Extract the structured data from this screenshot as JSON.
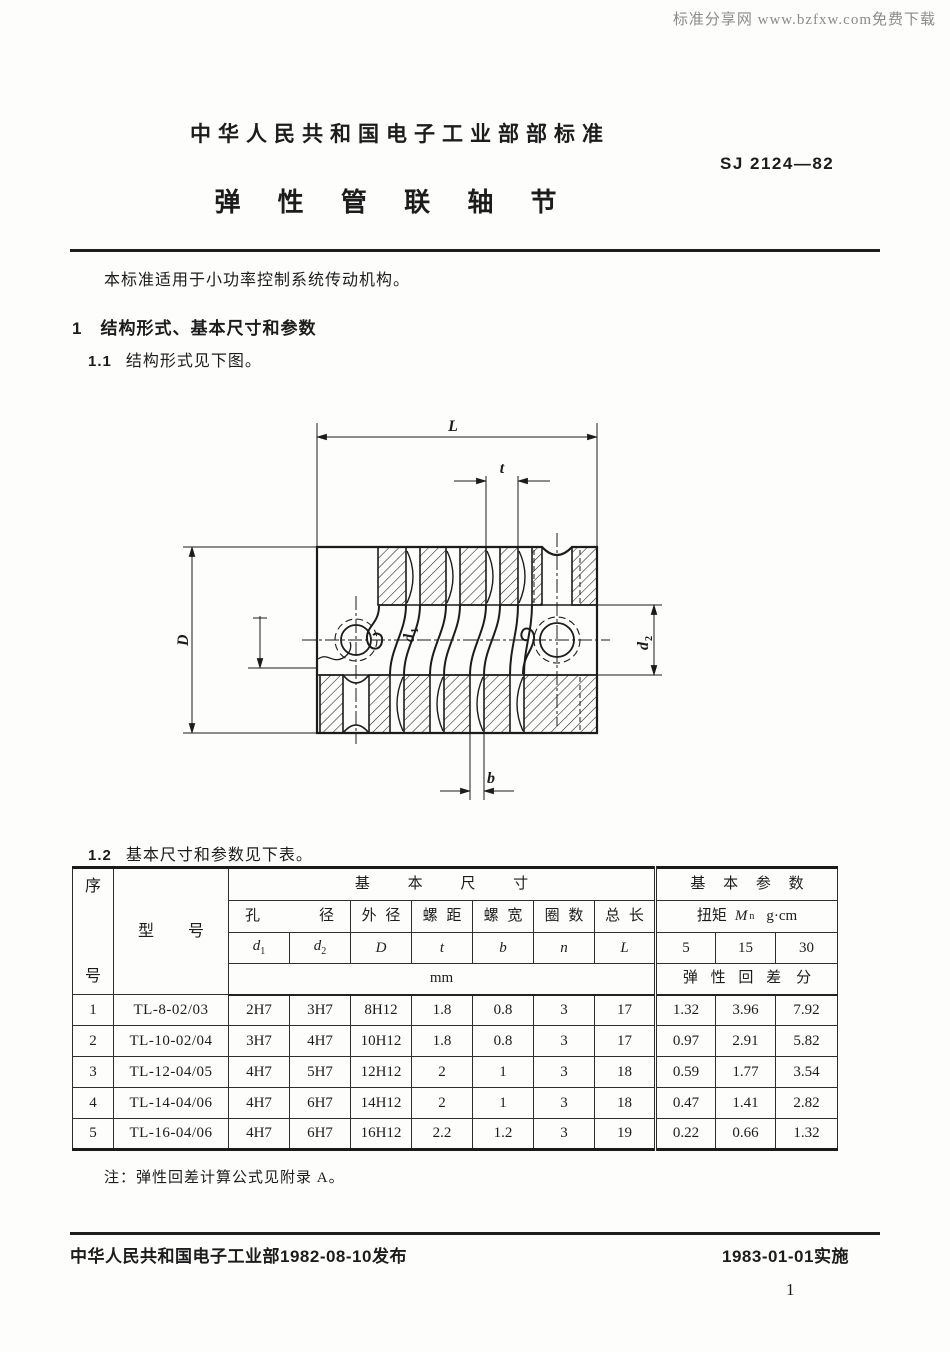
{
  "watermark": "标准分享网 www.bzfxw.com免费下载",
  "header": {
    "ministry_line": "中华人民共和国电子工业部部标准",
    "standard_no": "SJ 2124—82",
    "title": "弹 性 管 联 轴 节"
  },
  "intro": "本标准适用于小功率控制系统传动机构。",
  "section1": {
    "heading": "1　结构形式、基本尺寸和参数",
    "s11_num": "1.1",
    "s11_text": "结构形式见下图。",
    "s12_num": "1.2",
    "s12_text": "基本尺寸和参数见下表。"
  },
  "figure": {
    "labels": {
      "L": "L",
      "t": "t",
      "D": "D",
      "d": "d",
      "sub1": "1",
      "sub2": "2",
      "b": "b"
    }
  },
  "table": {
    "col_xu": "序",
    "col_hao": "号",
    "col_model": "型 号",
    "group_dims": "基 本 尺 寸",
    "group_params": "基 本 参 数",
    "sub_bore_left": "孔",
    "sub_bore_right": "径",
    "sub_od": "外 径",
    "sub_pitch": "螺 距",
    "sub_width": "螺 宽",
    "sub_turns": "圈 数",
    "sub_len": "总 长",
    "torque_prefix": "扭矩",
    "torque_symbol": "M",
    "torque_sub": "n",
    "torque_unit": "g·cm",
    "sym": {
      "d": "d",
      "s1": "1",
      "s2": "2",
      "D": "D",
      "t": "t",
      "b": "b",
      "n": "n",
      "L": "L"
    },
    "torque_values": [
      "5",
      "15",
      "30"
    ],
    "unit_mm": "mm",
    "backlash_label": "弹 性 回 差　分",
    "rows": [
      {
        "no": "1",
        "model": "TL-8-02/03",
        "d1": "2H7",
        "d2": "3H7",
        "D": "8H12",
        "t": "1.8",
        "b": "0.8",
        "n": "3",
        "L": "17",
        "v5": "1.32",
        "v15": "3.96",
        "v30": "7.92"
      },
      {
        "no": "2",
        "model": "TL-10-02/04",
        "d1": "3H7",
        "d2": "4H7",
        "D": "10H12",
        "t": "1.8",
        "b": "0.8",
        "n": "3",
        "L": "17",
        "v5": "0.97",
        "v15": "2.91",
        "v30": "5.82"
      },
      {
        "no": "3",
        "model": "TL-12-04/05",
        "d1": "4H7",
        "d2": "5H7",
        "D": "12H12",
        "t": "2",
        "b": "1",
        "n": "3",
        "L": "18",
        "v5": "0.59",
        "v15": "1.77",
        "v30": "3.54"
      },
      {
        "no": "4",
        "model": "TL-14-04/06",
        "d1": "4H7",
        "d2": "6H7",
        "D": "14H12",
        "t": "2",
        "b": "1",
        "n": "3",
        "L": "18",
        "v5": "0.47",
        "v15": "1.41",
        "v30": "2.82"
      },
      {
        "no": "5",
        "model": "TL-16-04/06",
        "d1": "4H7",
        "d2": "6H7",
        "D": "16H12",
        "t": "2.2",
        "b": "1.2",
        "n": "3",
        "L": "19",
        "v5": "0.22",
        "v15": "0.66",
        "v30": "1.32"
      }
    ]
  },
  "note": "注：弹性回差计算公式见附录 A。",
  "footer": {
    "left": "中华人民共和国电子工业部1982-08-10发布",
    "right": "1983-01-01实施",
    "page": "1"
  }
}
